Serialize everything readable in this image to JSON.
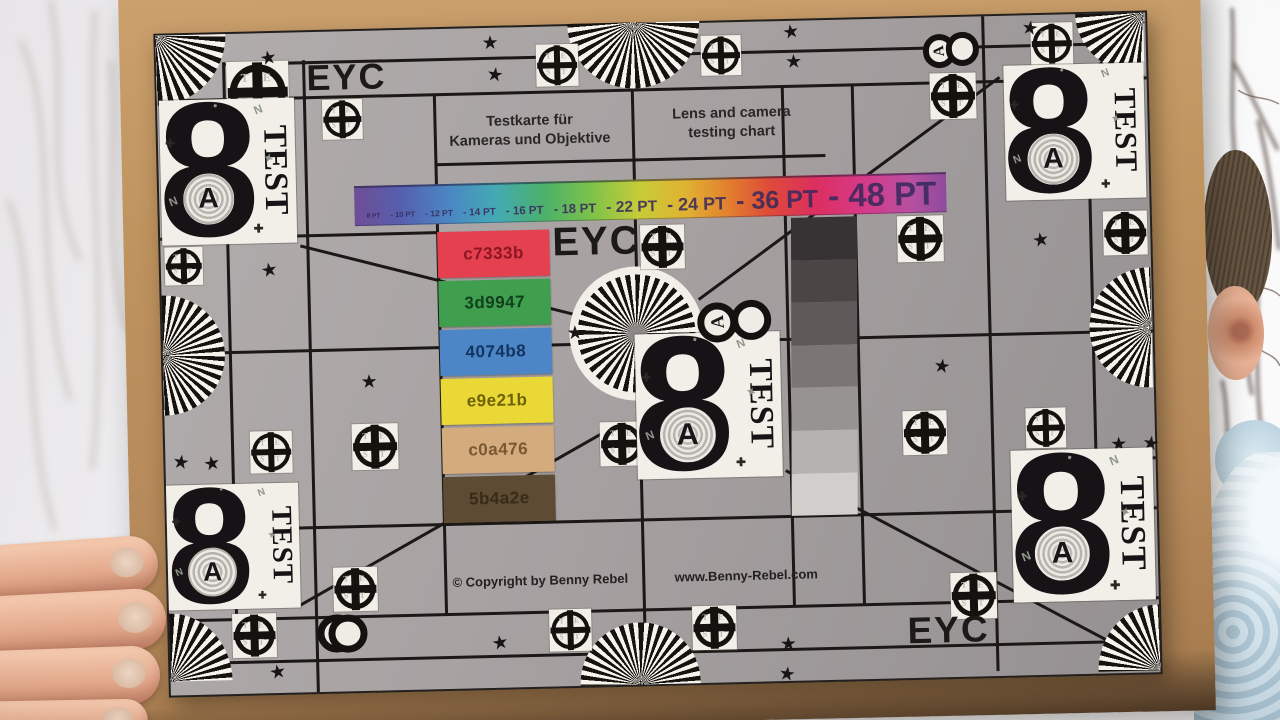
{
  "chart": {
    "eyc_label": "EYC",
    "title_german": {
      "line1": "Testkarte für",
      "line2": "Kameras und Objektive"
    },
    "title_english": {
      "line1": "Lens and camera",
      "line2": "testing chart"
    },
    "copyright": "© Copyright by Benny Rebel",
    "website": "www.Benny-Rebel.com",
    "font_size_bar": {
      "labels": [
        "8 PT",
        "10 PT",
        "12 PT",
        "14 PT",
        "16 PT",
        "18 PT",
        "22 PT",
        "24 PT",
        "36 PT",
        "48 PT"
      ],
      "separator": "-",
      "text_color": "#392a5c"
    },
    "color_patches": [
      {
        "hex_label": "c7333b",
        "display_color": "#e4404f",
        "text_color": "#8c1622"
      },
      {
        "hex_label": "3d9947",
        "display_color": "#3f9f4e",
        "text_color": "#123f1c"
      },
      {
        "hex_label": "4074b8",
        "display_color": "#4c86c6",
        "text_color": "#123460"
      },
      {
        "hex_label": "e9e21b",
        "display_color": "#e9d835",
        "text_color": "#6f6106"
      },
      {
        "hex_label": "c0a476",
        "display_color": "#d3ab7d",
        "text_color": "#7a5832"
      },
      {
        "hex_label": "5b4a2e",
        "display_color": "#5e4b33",
        "text_color": "#362a18"
      }
    ],
    "grayscale_steps": [
      "#373233",
      "#4b4546",
      "#5f5859",
      "#7b7574",
      "#979391",
      "#b5b2b0",
      "#d1cfcc"
    ],
    "test_block": {
      "digit": "8",
      "word": "TEST",
      "circle_letter": "A",
      "decor_glyphs": [
        "N",
        "✚",
        "✦",
        "N",
        "✚",
        "▪"
      ]
    },
    "marker_letters": [
      "T",
      "E",
      "S",
      "T"
    ],
    "star_glyph": "★",
    "surface_color": "#a7a1a2",
    "line_color": "#1b1817"
  },
  "scene_colors": {
    "cardboard": "#bb8f60",
    "sweater": "#cfe2ec",
    "skin": "#e3a98c",
    "hair": "#655442",
    "sky": "#f2f1f3"
  }
}
